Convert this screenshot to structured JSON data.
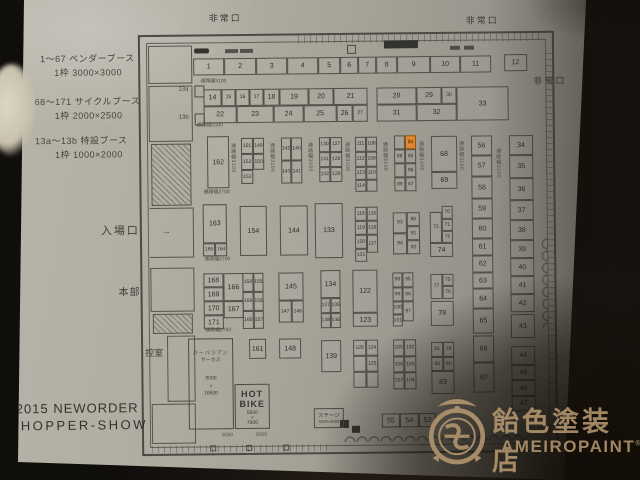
{
  "photo": {
    "paper_color": "#a5a398",
    "table_color": "#241d15",
    "line_color": "#4b4a44"
  },
  "legend": {
    "lines": [
      "1〜67  ベンダーブース",
      "1枠  3000×3000",
      "68〜171 サイクルブース",
      "1枠  2000×2500",
      "13a〜13b 特設ブース",
      "1枠  1000×2000"
    ]
  },
  "title": {
    "line1": "2015 NEWORDER",
    "line2": "CHOPPER-SHOW"
  },
  "watermark": {
    "jp": "飴色塗装店",
    "en": "AMEIROPAINT",
    "reg": "®"
  },
  "plan": {
    "exits": {
      "top_left": "非常口",
      "top_right": "非常口",
      "right": "非常口"
    },
    "entrance_label": "入場口",
    "entrance_arrow": "→",
    "hq_label": "本部",
    "waiting_label": "控室",
    "special_booth_a": "13a",
    "special_booth_b": "13b",
    "stage": {
      "name": "ステージ",
      "size": "5500×3000"
    },
    "hot_bike": {
      "line1": "HOT",
      "line2": "BIKE",
      "size1": "5500",
      "size2": "×",
      "size3": "7000"
    },
    "circus": {
      "line1": "バーバリアン",
      "line2": "サーカス",
      "size1": "9000",
      "size2": "×",
      "size3": "16500"
    },
    "dim_labels": [
      "8000",
      "8000"
    ],
    "highlight_booth": "84",
    "highlight_color": "#e0872f",
    "aisle_labels": [
      [
        "通路幅3100",
        202,
        78,
        0
      ],
      [
        "通路幅3100",
        198,
        122,
        0
      ],
      [
        "通路幅2700",
        204,
        189,
        0
      ],
      [
        "通路幅2700",
        204,
        256,
        0
      ],
      [
        "通路幅2700",
        204,
        327,
        0
      ],
      [
        "通路幅3100",
        231,
        142,
        1
      ],
      [
        "通路幅3100",
        270,
        142,
        1
      ],
      [
        "通路幅3100",
        308,
        142,
        1
      ],
      [
        "通路幅3100",
        345,
        142,
        1
      ],
      [
        "通路幅3100",
        383,
        142,
        1
      ],
      [
        "通路幅3100",
        419,
        142,
        1
      ],
      [
        "通路幅3100",
        459,
        142,
        1
      ],
      [
        "通路幅3100",
        496,
        150,
        1
      ]
    ],
    "booths": [
      [
        "1",
        195,
        57,
        31,
        17
      ],
      [
        "2",
        226,
        57,
        32,
        17
      ],
      [
        "3",
        258,
        57,
        31,
        17
      ],
      [
        "4",
        289,
        57,
        31,
        17
      ],
      [
        "5",
        320,
        57,
        22,
        17
      ],
      [
        "6",
        342,
        57,
        18,
        17
      ],
      [
        "7",
        360,
        57,
        18,
        17
      ],
      [
        "8",
        378,
        57,
        21,
        17
      ],
      [
        "9",
        399,
        57,
        33,
        17
      ],
      [
        "10",
        432,
        57,
        30,
        17
      ],
      [
        "11",
        462,
        57,
        31,
        17
      ],
      [
        "12",
        506,
        56,
        23,
        17
      ],
      [
        "14",
        205,
        88,
        18,
        17
      ],
      [
        "15",
        223,
        88,
        14,
        17
      ],
      [
        "16",
        237,
        88,
        14,
        17
      ],
      [
        "17",
        251,
        88,
        14,
        17
      ],
      [
        "18",
        265,
        88,
        16,
        17
      ],
      [
        "19",
        281,
        88,
        29,
        17
      ],
      [
        "20",
        310,
        88,
        25,
        17
      ],
      [
        "21",
        335,
        88,
        34,
        17
      ],
      [
        "22",
        205,
        105,
        33,
        17
      ],
      [
        "23",
        238,
        105,
        37,
        17
      ],
      [
        "24",
        275,
        105,
        30,
        17
      ],
      [
        "25",
        305,
        105,
        33,
        17
      ],
      [
        "26",
        338,
        105,
        16,
        17
      ],
      [
        "27",
        354,
        105,
        15,
        17
      ],
      [
        "28",
        378,
        88,
        40,
        17
      ],
      [
        "29",
        418,
        88,
        25,
        17
      ],
      [
        "30",
        443,
        88,
        15,
        17
      ],
      [
        "31",
        378,
        105,
        40,
        17
      ],
      [
        "32",
        418,
        105,
        40,
        17
      ],
      [
        "33",
        458,
        88,
        52,
        34
      ],
      [
        "162",
        208,
        135,
        22,
        52
      ],
      [
        "151",
        242,
        137,
        12,
        16
      ],
      [
        "149",
        254,
        137,
        11,
        16
      ],
      [
        "152",
        242,
        153,
        12,
        16
      ],
      [
        "150",
        254,
        153,
        11,
        16
      ],
      [
        "153",
        242,
        169,
        12,
        14
      ],
      [
        "142",
        282,
        137,
        10,
        23
      ],
      [
        "140",
        292,
        137,
        11,
        23
      ],
      [
        "143",
        282,
        160,
        10,
        23
      ],
      [
        "141",
        292,
        160,
        11,
        23
      ],
      [
        "130",
        320,
        137,
        11,
        15
      ],
      [
        "127",
        331,
        137,
        12,
        15
      ],
      [
        "131",
        320,
        152,
        11,
        15
      ],
      [
        "128",
        331,
        152,
        12,
        15
      ],
      [
        "132",
        320,
        167,
        11,
        15
      ],
      [
        "129",
        331,
        167,
        12,
        15
      ],
      [
        "111",
        356,
        137,
        11,
        15
      ],
      [
        "108",
        367,
        137,
        11,
        15
      ],
      [
        "112",
        356,
        152,
        11,
        15
      ],
      [
        "109",
        367,
        152,
        11,
        15
      ],
      [
        "113",
        356,
        167,
        11,
        13
      ],
      [
        "110",
        367,
        167,
        11,
        13
      ],
      [
        "114",
        356,
        180,
        11,
        12
      ],
      [
        "",
        367,
        180,
        11,
        12
      ],
      [
        "",
        395,
        136,
        11,
        14
      ],
      [
        "84",
        406,
        136,
        11,
        14
      ],
      [
        "88",
        395,
        150,
        11,
        14
      ],
      [
        "85",
        406,
        150,
        11,
        14
      ],
      [
        "",
        395,
        164,
        11,
        14
      ],
      [
        "86",
        406,
        164,
        11,
        14
      ],
      [
        "89",
        395,
        178,
        11,
        14
      ],
      [
        "87",
        406,
        178,
        11,
        14
      ],
      [
        "68",
        432,
        137,
        26,
        36
      ],
      [
        "69",
        432,
        173,
        26,
        17
      ],
      [
        "56",
        472,
        137,
        21,
        20
      ],
      [
        "57",
        472,
        157,
        21,
        21
      ],
      [
        "58",
        472,
        178,
        21,
        22
      ],
      [
        "59",
        472,
        200,
        21,
        20
      ],
      [
        "60",
        472,
        220,
        21,
        20
      ],
      [
        "61",
        472,
        240,
        21,
        17
      ],
      [
        "62",
        472,
        257,
        21,
        17
      ],
      [
        "63",
        472,
        274,
        21,
        16
      ],
      [
        "64",
        472,
        290,
        21,
        20
      ],
      [
        "65",
        472,
        310,
        21,
        25
      ],
      [
        "66",
        472,
        337,
        21,
        27
      ],
      [
        "67",
        472,
        364,
        21,
        30
      ],
      [
        "34",
        510,
        137,
        24,
        20
      ],
      [
        "35",
        510,
        157,
        24,
        23
      ],
      [
        "36",
        510,
        180,
        24,
        22
      ],
      [
        "37",
        510,
        202,
        24,
        20
      ],
      [
        "38",
        510,
        222,
        24,
        20
      ],
      [
        "39",
        510,
        242,
        24,
        18
      ],
      [
        "40",
        510,
        260,
        24,
        18
      ],
      [
        "41",
        510,
        278,
        24,
        18
      ],
      [
        "42",
        510,
        296,
        24,
        18
      ],
      [
        "43",
        510,
        316,
        24,
        24
      ],
      [
        "44",
        510,
        348,
        24,
        19
      ],
      [
        "45",
        510,
        367,
        24,
        15
      ],
      [
        "46",
        510,
        382,
        24,
        16
      ],
      [
        "47",
        510,
        398,
        24,
        15
      ],
      [
        "163",
        203,
        203,
        24,
        39
      ],
      [
        "165",
        203,
        242,
        12,
        13
      ],
      [
        "164",
        215,
        242,
        12,
        13
      ],
      [
        "154",
        240,
        205,
        27,
        50
      ],
      [
        "144",
        280,
        205,
        28,
        50
      ],
      [
        "133",
        315,
        203,
        28,
        55
      ],
      [
        "118",
        355,
        207,
        12,
        14
      ],
      [
        "115",
        367,
        207,
        11,
        14
      ],
      [
        "119",
        355,
        221,
        12,
        14
      ],
      [
        "116",
        367,
        221,
        11,
        14
      ],
      [
        "120",
        355,
        235,
        12,
        14
      ],
      [
        "117",
        367,
        235,
        11,
        18
      ],
      [
        "121",
        355,
        249,
        12,
        13
      ],
      [
        "93",
        393,
        213,
        14,
        21
      ],
      [
        "90",
        407,
        213,
        13,
        14
      ],
      [
        "91",
        407,
        227,
        13,
        14
      ],
      [
        "94",
        393,
        234,
        14,
        21
      ],
      [
        "92",
        407,
        241,
        13,
        14
      ],
      [
        "70",
        442,
        207,
        11,
        13
      ],
      [
        "73",
        430,
        213,
        12,
        31
      ],
      [
        "71",
        442,
        220,
        11,
        12
      ],
      [
        "72",
        442,
        232,
        11,
        12
      ],
      [
        "74",
        430,
        244,
        23,
        14
      ],
      [
        "168",
        203,
        272,
        20,
        14
      ],
      [
        "166",
        223,
        272,
        20,
        28
      ],
      [
        "169",
        203,
        286,
        20,
        14
      ],
      [
        "170",
        203,
        300,
        20,
        14
      ],
      [
        "167",
        223,
        300,
        20,
        17
      ],
      [
        "171",
        203,
        314,
        20,
        14
      ],
      [
        "158",
        242,
        272,
        11,
        19
      ],
      [
        "155",
        253,
        272,
        10,
        19
      ],
      [
        "159",
        242,
        291,
        11,
        19
      ],
      [
        "156",
        253,
        291,
        10,
        19
      ],
      [
        "160",
        242,
        310,
        11,
        18
      ],
      [
        "157",
        253,
        310,
        10,
        18
      ],
      [
        "145",
        278,
        272,
        25,
        28
      ],
      [
        "147",
        278,
        300,
        13,
        22
      ],
      [
        "146",
        291,
        300,
        12,
        22
      ],
      [
        "134",
        320,
        270,
        20,
        28
      ],
      [
        "137",
        320,
        298,
        10,
        15
      ],
      [
        "135",
        330,
        298,
        10,
        15
      ],
      [
        "138",
        320,
        313,
        10,
        15
      ],
      [
        "136",
        330,
        313,
        10,
        15
      ],
      [
        "122",
        352,
        270,
        25,
        43
      ],
      [
        "123",
        352,
        313,
        25,
        14
      ],
      [
        "98",
        392,
        273,
        10,
        15
      ],
      [
        "95",
        402,
        273,
        11,
        15
      ],
      [
        "99",
        392,
        288,
        10,
        14
      ],
      [
        "96",
        402,
        288,
        11,
        14
      ],
      [
        "100",
        392,
        302,
        10,
        13
      ],
      [
        "97",
        402,
        302,
        11,
        20
      ],
      [
        "101",
        392,
        315,
        10,
        12
      ],
      [
        "77",
        430,
        275,
        12,
        25
      ],
      [
        "75",
        442,
        275,
        11,
        12
      ],
      [
        "76",
        442,
        287,
        11,
        13
      ],
      [
        "78",
        430,
        302,
        23,
        25
      ],
      [
        "161",
        248,
        338,
        17,
        20
      ],
      [
        "148",
        278,
        338,
        22,
        20
      ],
      [
        "139",
        320,
        340,
        20,
        32
      ],
      [
        "126",
        352,
        340,
        13,
        16
      ],
      [
        "124",
        365,
        340,
        12,
        16
      ],
      [
        "",
        352,
        356,
        13,
        16
      ],
      [
        "125",
        365,
        356,
        12,
        16
      ],
      [
        "",
        352,
        372,
        13,
        16
      ],
      [
        "",
        365,
        372,
        12,
        16
      ],
      [
        "105",
        392,
        340,
        11,
        17
      ],
      [
        "102",
        403,
        340,
        12,
        17
      ],
      [
        "106",
        392,
        357,
        11,
        16
      ],
      [
        "103",
        403,
        357,
        12,
        16
      ],
      [
        "107",
        392,
        373,
        11,
        17
      ],
      [
        "104",
        403,
        373,
        12,
        17
      ],
      [
        "81",
        430,
        343,
        12,
        15
      ],
      [
        "79",
        442,
        343,
        11,
        15
      ],
      [
        "82",
        430,
        358,
        12,
        14
      ],
      [
        "80",
        442,
        358,
        11,
        14
      ],
      [
        "83",
        430,
        372,
        23,
        23
      ],
      [
        "55",
        380,
        414,
        18,
        14
      ],
      [
        "54",
        398,
        414,
        19,
        14
      ],
      [
        "53",
        417,
        414,
        17,
        14
      ]
    ]
  }
}
